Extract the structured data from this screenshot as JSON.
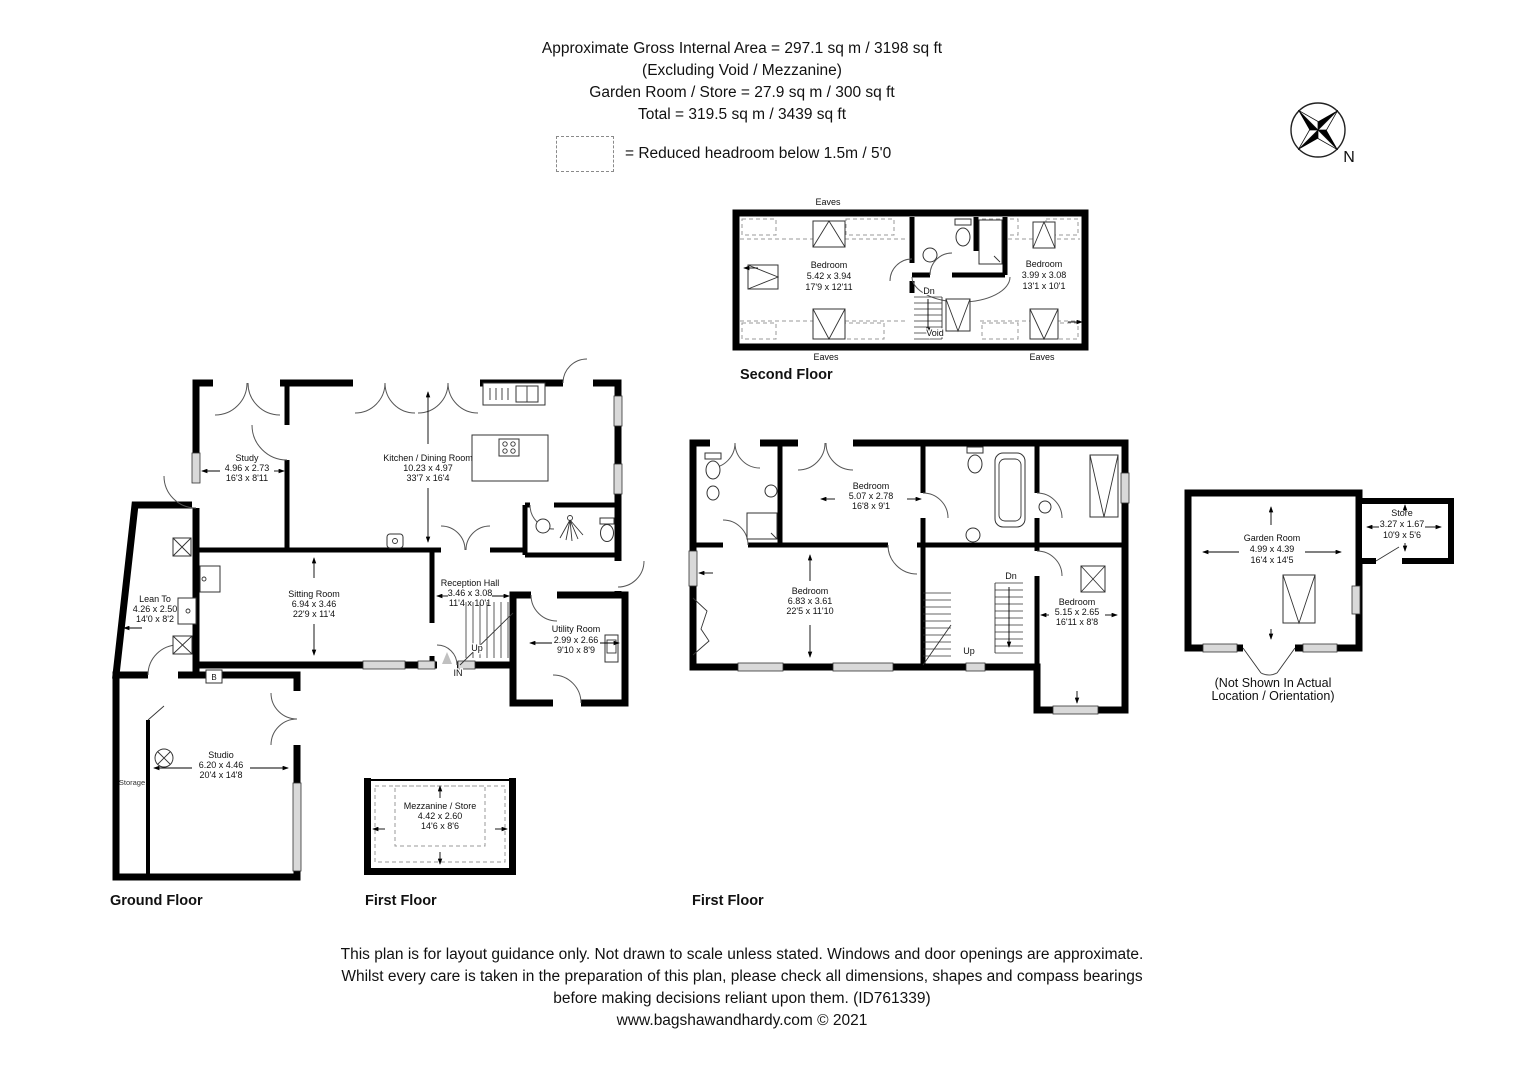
{
  "header": {
    "line1": "Approximate Gross Internal Area = 297.1 sq m / 3198 sq ft",
    "line2": "(Excluding Void / Mezzanine)",
    "line3": "Garden Room / Store = 27.9 sq m / 300 sq ft",
    "line4": "Total = 319.5 sq m / 3439 sq ft"
  },
  "legend": {
    "text": "= Reduced headroom below 1.5m / 5'0"
  },
  "compass": {
    "north_label": "N"
  },
  "floor_titles": {
    "ground": "Ground Floor",
    "first_mezzanine": "First Floor",
    "first_main": "First Floor",
    "second": "Second Floor"
  },
  "rooms": {
    "study": {
      "name": "Study",
      "metric": "4.96 x 2.73",
      "imperial": "16'3 x 8'11"
    },
    "kitchen_dining": {
      "name": "Kitchen / Dining Room",
      "metric": "10.23 x 4.97",
      "imperial": "33'7 x 16'4"
    },
    "lean_to": {
      "name": "Lean To",
      "metric": "4.26 x 2.50",
      "imperial": "14'0 x 8'2"
    },
    "sitting_room": {
      "name": "Sitting Room",
      "metric": "6.94 x 3.46",
      "imperial": "22'9 x 11'4"
    },
    "reception_hall": {
      "name": "Reception Hall",
      "metric": "3.46 x 3.08",
      "imperial": "11'4 x 10'1"
    },
    "utility_room": {
      "name": "Utility Room",
      "metric": "2.99 x 2.66",
      "imperial": "9'10 x 8'9"
    },
    "studio": {
      "name": "Studio",
      "metric": "6.20 x 4.46",
      "imperial": "20'4 x 14'8"
    },
    "mezzanine_store": {
      "name": "Mezzanine / Store",
      "metric": "4.42 x 2.60",
      "imperial": "14'6 x 8'6"
    },
    "bedroom_ff_top": {
      "name": "Bedroom",
      "metric": "5.07 x 2.78",
      "imperial": "16'8 x 9'1"
    },
    "bedroom_ff_left": {
      "name": "Bedroom",
      "metric": "6.83 x 3.61",
      "imperial": "22'5 x 11'10"
    },
    "bedroom_ff_right": {
      "name": "Bedroom",
      "metric": "5.15 x 2.65",
      "imperial": "16'11 x 8'8"
    },
    "bedroom_sf_left": {
      "name": "Bedroom",
      "metric": "5.42 x 3.94",
      "imperial": "17'9 x 12'11"
    },
    "bedroom_sf_right": {
      "name": "Bedroom",
      "metric": "3.99 x 3.08",
      "imperial": "13'1 x 10'1"
    },
    "garden_room": {
      "name": "Garden Room",
      "metric": "4.99 x 4.39",
      "imperial": "16'4 x 14'5"
    },
    "garden_store": {
      "name": "Store",
      "metric": "3.27 x 1.67",
      "imperial": "10'9 x 5'6"
    }
  },
  "annotations": {
    "eaves": "Eaves",
    "dn": "Dn",
    "up": "Up",
    "in": "IN",
    "void": "Void",
    "storage": "Storage",
    "boiler": "B",
    "garden_note_line1": "(Not Shown In Actual",
    "garden_note_line2": "Location / Orientation)"
  },
  "footer": {
    "line1": "This plan is for layout guidance only. Not drawn to scale unless stated. Windows and door openings are approximate.",
    "line2": "Whilst every care is taken in the preparation of this plan, please check all dimensions, shapes and compass bearings",
    "line3": "before making decisions reliant upon them. (ID761339)",
    "line4": "www.bagshawandhardy.com © 2021"
  }
}
